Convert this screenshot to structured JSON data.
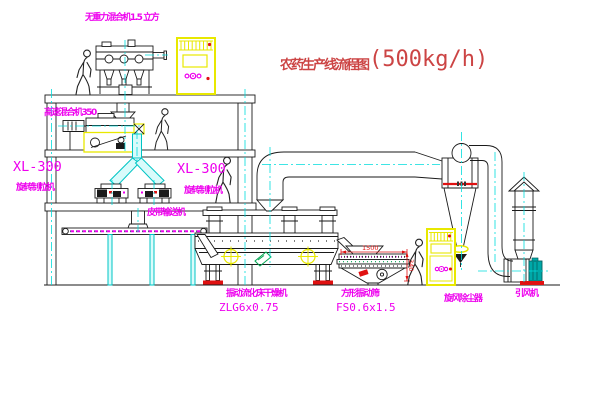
{
  "title": {
    "text": "农药生产线流程图",
    "capacity": "(500kg/h)"
  },
  "labels": {
    "gravity_mixer": "无重力混合机1.5 立方",
    "high_speed_mixer": "高速混合机350",
    "granulator_model_left": "XL-300",
    "granulator_name_left": "旋转制粒机",
    "granulator_model_right": "XL-300",
    "granulator_name_right": "旋转制粒机",
    "belt_conveyor": "皮带输送机",
    "fluid_bed_dryer": "振动流化床干燥机",
    "fluid_bed_dryer_model": "ZLG6x0.75",
    "vibrating_screen": "方形振动筛",
    "vibrating_screen_model": "FS0.6x1.5",
    "cyclone": "旋风除尘器",
    "induced_draft_fan": "引风机"
  },
  "dimensions": {
    "screen_length": "1500",
    "screen_height": "340"
  },
  "colors": {
    "label": "#ee00ee",
    "title": "#cc4444",
    "dimension": "#e01111",
    "centerline": "#00dddd",
    "highlight": "#e8e800",
    "line": "#1a1a1a",
    "background": "#ffffff"
  }
}
